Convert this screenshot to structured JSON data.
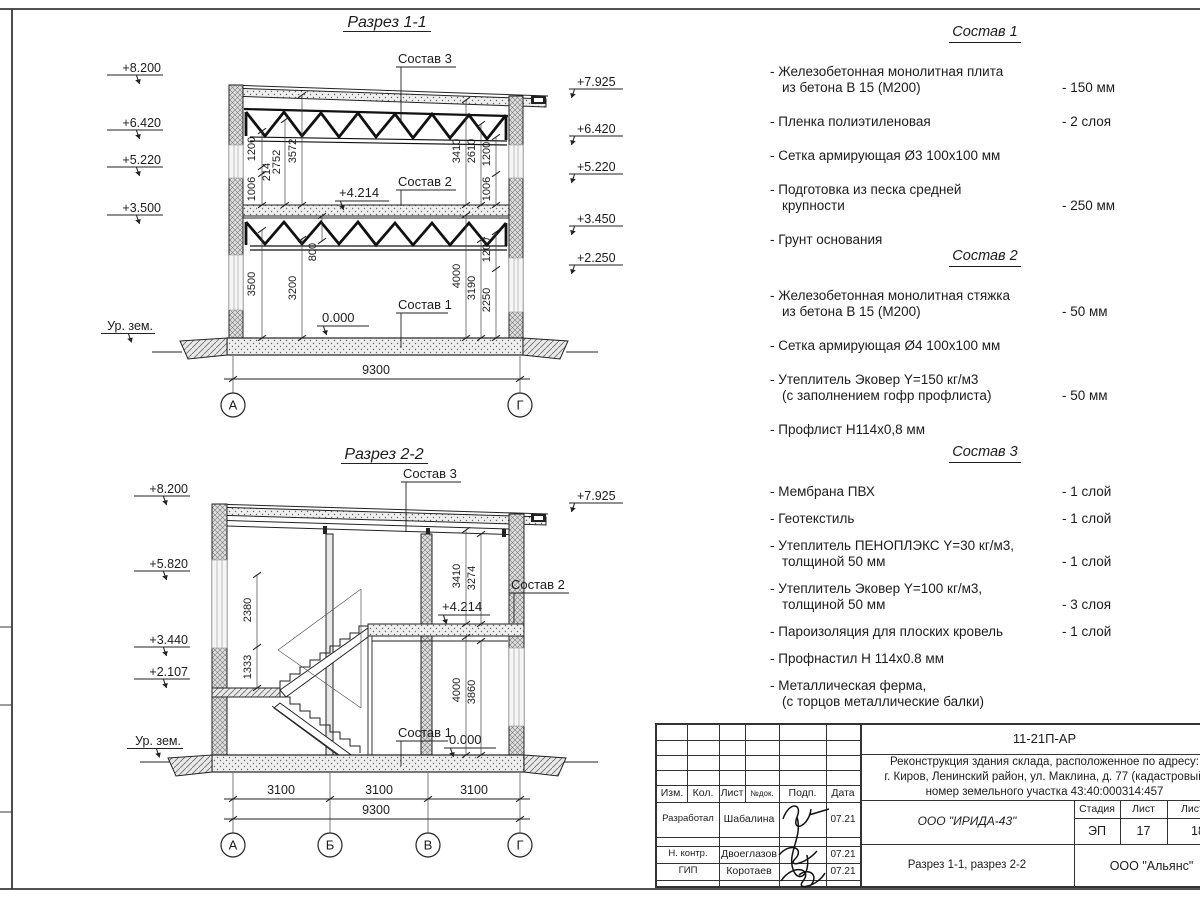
{
  "s1": {
    "title": "Разрез 1-1",
    "elevL": [
      "+8.200",
      "+6.420",
      "+5.220",
      "+3.500"
    ],
    "elevR": [
      "+7.925",
      "+6.420",
      "+5.220",
      "+3.450",
      "+2.250"
    ],
    "ground": "Ур. зем.",
    "c1": "Состав 1",
    "c2": "Состав 2",
    "c3": "Состав 3",
    "m4214": "+4.214",
    "m0": "0.000",
    "d": {
      "a1006": "1006",
      "a214": "214",
      "a1200": "1200",
      "a2752": "2752",
      "a3572": "3572",
      "b3410": "3410",
      "b2610": "2610",
      "b1200": "1200",
      "b1006": "1006",
      "c3500": "3500",
      "c3200": "3200",
      "c800": "800",
      "e4000": "4000",
      "e3190": "3190",
      "e2250": "2250",
      "e1200": "1200",
      "w": "9300"
    },
    "axes": [
      "А",
      "Г"
    ]
  },
  "s2": {
    "title": "Разрез 2-2",
    "elevL": [
      "+8.200",
      "+5.820",
      "+3.440",
      "+2.107"
    ],
    "elevR": [
      "+7.925"
    ],
    "ground": "Ур. зем.",
    "c1": "Состав 1",
    "c2": "Состав 2",
    "c3": "Состав 3",
    "m4214": "+4.214",
    "m0": "0.000",
    "d": {
      "a2380": "2380",
      "a1333": "1333",
      "b3410": "3410",
      "b3274": "3274",
      "c4000": "4000",
      "c3860": "3860",
      "s1": "3100",
      "s2": "3100",
      "s3": "3100",
      "w": "9300"
    },
    "axes": [
      "А",
      "Б",
      "В",
      "Г"
    ]
  },
  "sostav1": {
    "title": "Состав 1",
    "items": [
      {
        "t": "- Железобетонная  монолитная плита\nиз бетона В 15 (М200)",
        "v": "- 150 мм"
      },
      {
        "t": "- Пленка полиэтиленовая",
        "v": "-  2 слоя"
      },
      {
        "t": "- Сетка армирующая Ø3 100х100 мм",
        "v": ""
      },
      {
        "t": "- Подготовка из песка средней\nкрупности",
        "v": "- 250 мм"
      },
      {
        "t": "- Грунт основания",
        "v": ""
      }
    ]
  },
  "sostav2": {
    "title": "Состав 2",
    "items": [
      {
        "t": "- Железобетонная  монолитная стяжка\nиз бетона В 15 (М200)",
        "v": "- 50 мм"
      },
      {
        "t": "- Сетка армирующая Ø4 100х100 мм",
        "v": ""
      },
      {
        "t": "- Утеплитель Эковер Y=150 кг/м3\n(с заполнением гофр профлиста)",
        "v": "- 50 мм"
      },
      {
        "t": "- Профлист Н114х0,8 мм",
        "v": ""
      }
    ]
  },
  "sostav3": {
    "title": "Состав 3",
    "items": [
      {
        "t": "- Мембрана ПВХ",
        "v": "- 1 слой"
      },
      {
        "t": "- Геотекстиль",
        "v": "- 1 слой"
      },
      {
        "t": "- Утеплитель ПЕНОПЛЭКС Y=30 кг/м3,\nтолщиной 50 мм",
        "v": "- 1 слой"
      },
      {
        "t": "- Утеплитель Эковер Y=100 кг/м3,\nтолщиной 50 мм",
        "v": "- 3 слоя"
      },
      {
        "t": "- Пароизоляция для плоских кровель",
        "v": "- 1 слой"
      },
      {
        "t": "- Профнастил Н 114х0.8 мм",
        "v": ""
      },
      {
        "t": "- Металлическая ферма,\n(с торцов металлические балки)",
        "v": ""
      }
    ]
  },
  "tb": {
    "doc": "11-21П-АР",
    "proj1": "Реконструкция здания склада, расположенное по адресу:",
    "proj2": "г. Киров, Ленинский район, ул. Маклина, д. 77 (кадастровый",
    "proj3": "номер земельного участка 43:40:000314:457",
    "h": [
      "Изм.",
      "Кол.",
      "Лист",
      "№док.",
      "Подп.",
      "Дата"
    ],
    "rows": [
      {
        "role": "Разработал",
        "name": "Шабалина",
        "date": "07.21"
      },
      {
        "role": "Н. контр.",
        "name": "Двоеглазов",
        "date": "07.21"
      },
      {
        "role": "ГИП",
        "name": "Коротаев",
        "date": "07.21"
      }
    ],
    "org": "ООО \"ИРИДА-43\"",
    "stage_h": "Стадия",
    "sheet_h": "Лист",
    "sheets_h": "Листов",
    "stage": "ЭП",
    "sheet": "17",
    "sheets": "18",
    "drawing": "Разрез 1-1, разрез 2-2",
    "firm": "ООО \"Альянс\""
  }
}
